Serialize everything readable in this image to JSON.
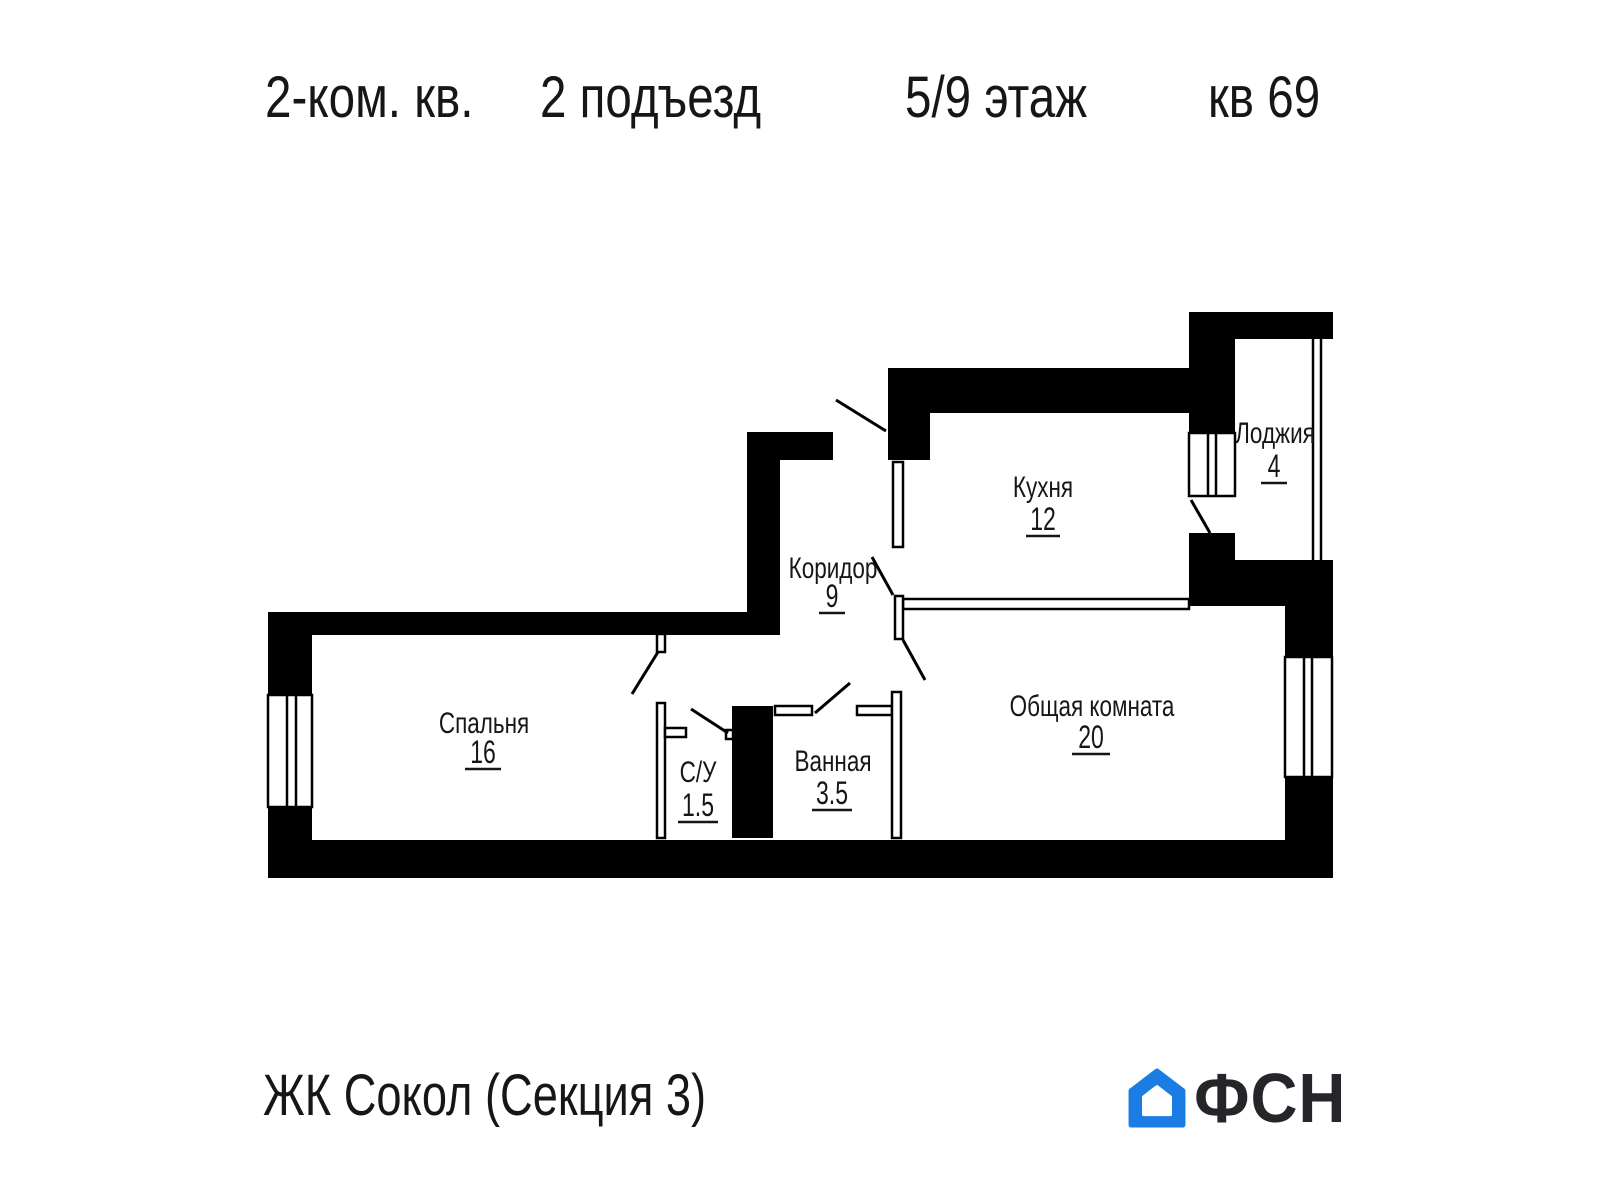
{
  "header": {
    "apartment_type": "2-ком. кв.",
    "entrance": "2 подъезд",
    "floor": "5/9 этаж",
    "apartment_number": "кв 69"
  },
  "rooms": [
    {
      "name": "Кухня",
      "area": "12"
    },
    {
      "name": "Лоджия",
      "area": "4"
    },
    {
      "name": "Коридор",
      "area": "9"
    },
    {
      "name": "Спальня",
      "area": "16"
    },
    {
      "name": "С/У",
      "area": "1.5"
    },
    {
      "name": "Ванная",
      "area": "3.5"
    },
    {
      "name": "Общая комната",
      "area": "20"
    }
  ],
  "footer": {
    "complex_name": "ЖК Сокол (Секция 3)",
    "logo_text": "ФСН"
  },
  "colors": {
    "walls": "#000000",
    "background": "#ffffff",
    "logo_blue": "#1b7ce4",
    "logo_text": "#24262a"
  }
}
